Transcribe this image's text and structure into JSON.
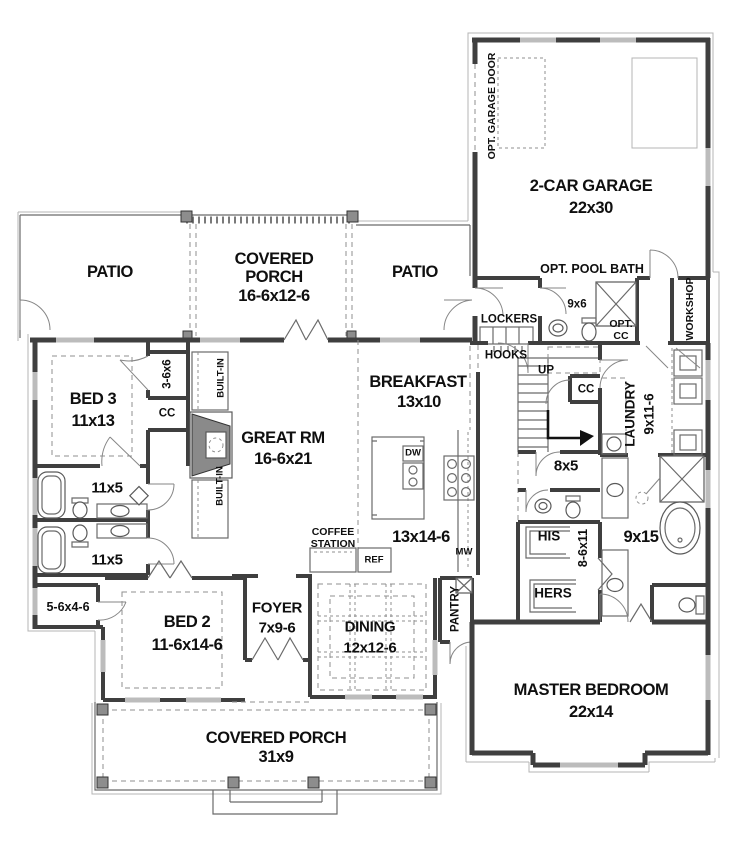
{
  "meta": {
    "type": "architectural-first-floor-plan"
  },
  "colors": {
    "bg": "#ffffff",
    "wall": "#3f3f3f",
    "window": "#bcbcbc",
    "thin": "#6a6a6a",
    "light": "#b4b4b4",
    "dash": "#8f8f8f",
    "fixture": "#5a5a5a",
    "post": "#8d8d8d",
    "text": "#0f0f0f"
  },
  "rooms": {
    "patio_left": {
      "name": "PATIO"
    },
    "patio_right": {
      "name": "PATIO"
    },
    "porch_top": {
      "name1": "COVERED",
      "name2": "PORCH",
      "dims": "16-6x12-6"
    },
    "garage": {
      "name": "2-CAR GARAGE",
      "dims": "22x30",
      "door_note": "OPT. GARAGE DOOR"
    },
    "pool_bath": {
      "name": "OPT. POOL BATH",
      "dims": "9x6",
      "closet1": "OPT.",
      "closet2": "CC"
    },
    "workshop": {
      "name": "WORKSHOP"
    },
    "mudroom": {
      "lockers": "LOCKERS",
      "hooks": "HOOKS"
    },
    "bed3": {
      "name": "BED 3",
      "dims": "11x13",
      "closet": "3-6x6",
      "cc": "CC"
    },
    "great_room": {
      "name": "GREAT RM",
      "dims": "16-6x21",
      "builtin_top": "BUILT-IN",
      "builtin_bottom": "BUILT-IN"
    },
    "breakfast": {
      "name": "BREAKFAST",
      "dims": "13x10"
    },
    "kitchen": {
      "dims": "13x14-6",
      "dw": "DW",
      "mw": "MW",
      "ref": "REF",
      "coffee1": "COFFEE",
      "coffee2": "STATION"
    },
    "stairs": {
      "up": "UP",
      "cc": "CC"
    },
    "laundry": {
      "name": "LAUNDRY",
      "dims": "9x11-6"
    },
    "hall": {
      "dims": "8x5"
    },
    "master_closet": {
      "his": "HIS",
      "hers": "HERS",
      "dims": "8-6x11"
    },
    "master_bath": {
      "dims": "9x15"
    },
    "bath1": {
      "dims": "11x5"
    },
    "bath2": {
      "dims": "11x5"
    },
    "closet_hall": {
      "dims": "5-6x4-6"
    },
    "bed2": {
      "name": "BED 2",
      "dims": "11-6x14-6"
    },
    "foyer": {
      "name": "FOYER",
      "dims": "7x9-6"
    },
    "dining": {
      "name": "DINING",
      "dims": "12x12-6"
    },
    "pantry": {
      "name": "PANTRY"
    },
    "master": {
      "name": "MASTER BEDROOM",
      "dims": "22x14"
    },
    "porch_bottom": {
      "name": "COVERED PORCH",
      "dims": "31x9"
    }
  }
}
